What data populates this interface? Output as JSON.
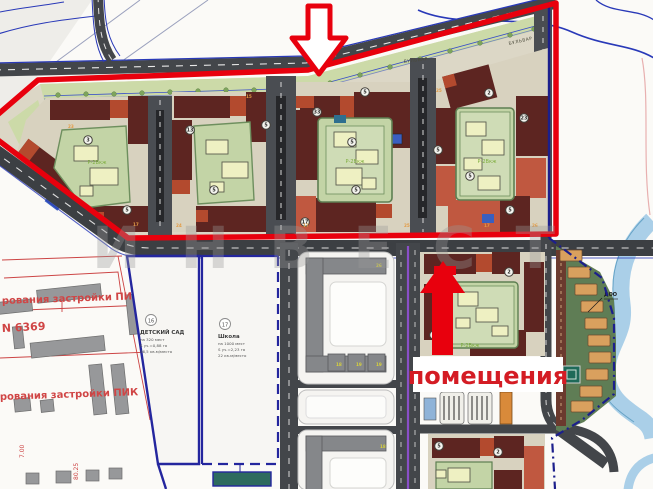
{
  "map": {
    "watermark": "ИНВЕСТ",
    "annotations": {
      "premises": "помещения",
      "pik_line_1": "рования застройки ПИК",
      "plan_no": "N 6369",
      "pik_line_2": "рования застройки ПИК",
      "dim_a": "7.00",
      "dim_b": "80.25",
      "doo": "ДОО"
    },
    "boulevard": {
      "label_1": "БУЛЬВАР",
      "label_2": "БУЛЬВАР"
    },
    "kindergarten": {
      "num": "16",
      "title": "ДЕТСКИЙ САД",
      "lines": [
        "на 320 мест",
        "S уч.=0,88 га",
        "36,5 кв.м/место"
      ]
    },
    "school": {
      "num": "17",
      "title": "Школа",
      "lines": [
        "на 1000 мест",
        "S уч.=2,23 га",
        "22 кв.м/место"
      ]
    },
    "courtyard_label": "Р-2Вкж",
    "courtyard_label_pos": [
      [
        97,
        164
      ],
      [
        355,
        163
      ],
      [
        487,
        163
      ],
      [
        470,
        347
      ]
    ],
    "markers": [
      {
        "n": "3",
        "x": 88,
        "y": 140
      },
      {
        "n": "5",
        "x": 127,
        "y": 210
      },
      {
        "n": "13",
        "x": 190,
        "y": 130
      },
      {
        "n": "5",
        "x": 214,
        "y": 190
      },
      {
        "n": "33",
        "x": 317,
        "y": 112
      },
      {
        "n": "5",
        "x": 352,
        "y": 142
      },
      {
        "n": "5",
        "x": 356,
        "y": 190
      },
      {
        "n": "17",
        "x": 305,
        "y": 222
      },
      {
        "n": "5",
        "x": 266,
        "y": 125
      },
      {
        "n": "2",
        "x": 489,
        "y": 93
      },
      {
        "n": "5",
        "x": 438,
        "y": 150
      },
      {
        "n": "5",
        "x": 470,
        "y": 176
      },
      {
        "n": "23",
        "x": 524,
        "y": 118
      },
      {
        "n": "5",
        "x": 510,
        "y": 210
      },
      {
        "n": "2",
        "x": 509,
        "y": 272
      },
      {
        "n": "5",
        "x": 365,
        "y": 92
      },
      {
        "n": "5",
        "x": 439,
        "y": 446
      },
      {
        "n": "2",
        "x": 498,
        "y": 452
      },
      {
        "n": "5",
        "x": 434,
        "y": 335
      }
    ],
    "building_numbers": [
      {
        "n": "17",
        "x": 133,
        "y": 226
      },
      {
        "n": "24",
        "x": 176,
        "y": 227
      },
      {
        "n": "17",
        "x": 303,
        "y": 227
      },
      {
        "n": "25",
        "x": 404,
        "y": 227
      },
      {
        "n": "17",
        "x": 484,
        "y": 227
      },
      {
        "n": "26",
        "x": 532,
        "y": 227
      },
      {
        "n": "23",
        "x": 68,
        "y": 128
      },
      {
        "n": "15",
        "x": 246,
        "y": 98
      },
      {
        "n": "25",
        "x": 436,
        "y": 92
      }
    ],
    "yellow_numbers": [
      {
        "n": "26",
        "x": 376,
        "y": 267
      },
      {
        "n": "18",
        "x": 336,
        "y": 366
      },
      {
        "n": "19",
        "x": 356,
        "y": 366
      },
      {
        "n": "19",
        "x": 376,
        "y": 366
      },
      {
        "n": "18",
        "x": 380,
        "y": 448
      }
    ],
    "trees": [
      [
        58,
        95
      ],
      [
        86,
        94
      ],
      [
        114,
        94
      ],
      [
        142,
        93
      ],
      [
        170,
        92
      ],
      [
        198,
        91
      ],
      [
        226,
        90
      ],
      [
        254,
        90
      ],
      [
        282,
        89
      ],
      [
        330,
        83
      ],
      [
        360,
        75
      ],
      [
        390,
        67
      ],
      [
        420,
        59
      ],
      [
        450,
        51
      ],
      [
        480,
        43
      ],
      [
        510,
        35
      ],
      [
        534,
        29
      ]
    ],
    "tan_houses": [
      [
        560,
        250
      ],
      [
        568,
        267
      ],
      [
        575,
        284
      ],
      [
        581,
        301
      ],
      [
        585,
        318
      ],
      [
        588,
        335
      ],
      [
        589,
        352
      ],
      [
        586,
        369
      ],
      [
        580,
        386
      ],
      [
        571,
        401
      ]
    ],
    "colors": {
      "boundary_red": "#e8000d",
      "annotation_red": "#d04545",
      "building_maroon": "#5d2521",
      "building_salmon": "#c05840",
      "building_orange": "#b34a2e",
      "courtyard_green": "#c3d4a6",
      "inner_yellow": "#eef0c2",
      "road_dark": "#43464a",
      "parcel_blue": "#24269e",
      "river_blue": "#aacfe8",
      "gray_building": "#97989a",
      "tan_building": "#d9a05e"
    }
  }
}
